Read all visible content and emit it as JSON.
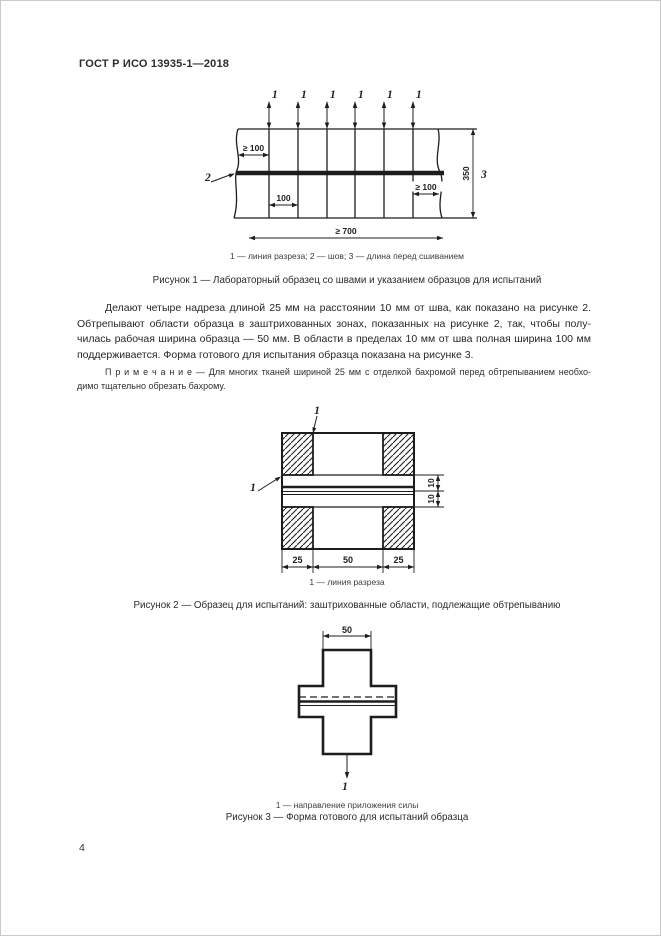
{
  "page": {
    "header": "ГОСТ Р ИСО 13935-1—2018",
    "page_number": "4"
  },
  "figure1": {
    "callouts": {
      "cut_line": "1",
      "seam": "2",
      "length_before_sewing": "3"
    },
    "dims": {
      "edge_to_cut_left": "≥ 100",
      "cut_spacing": "100",
      "edge_to_cut_right": "≥ 100",
      "height": "350",
      "total_width": "≥ 700"
    },
    "legend": "1 — линия разреза; 2 —  шов; 3 —  длина перед сшиванием",
    "caption": "Рисунок 1 — Лабораторный образец со швами и указанием образцов для  испытаний"
  },
  "paragraph": {
    "lines": [
      "Делают четыре надреза длиной 25 мм на расстоянии 10 мм от шва, как показано на рисунке 2.",
      "Обтрепывают области образца в заштрихованных зонах, показанных на рисунке 2, так, чтобы полу-",
      "чилась рабочая ширина образца — 50 мм. В области  в пределах 10 мм от шва полная ширина 100 мм",
      "поддерживается. Форма готового для испытания образца показана на рисунке 3."
    ]
  },
  "note": {
    "lines": [
      "П р и м е ч а н и е   — Для многих тканей шириной 25 мм с отделкой бахромой перед  обтрепыванием необхо-",
      "димо тщательно обрезать бахрому."
    ]
  },
  "figure2": {
    "callouts": {
      "cut_line_top": "1",
      "cut_line_left": "1"
    },
    "dims": {
      "left": "25",
      "center": "50",
      "right": "25",
      "upper": "10",
      "lower": "10"
    },
    "legend": "1 —  линия разреза",
    "caption": "Рисунок 2 — Образец для испытаний: заштрихованные области, подлежащие обтрепыванию"
  },
  "figure3": {
    "callouts": {
      "force_direction": "1"
    },
    "dims": {
      "width": "50"
    },
    "legend": "1 — направление приложения силы",
    "caption": "Рисунок 3 — Форма готового для испытаний образца"
  }
}
